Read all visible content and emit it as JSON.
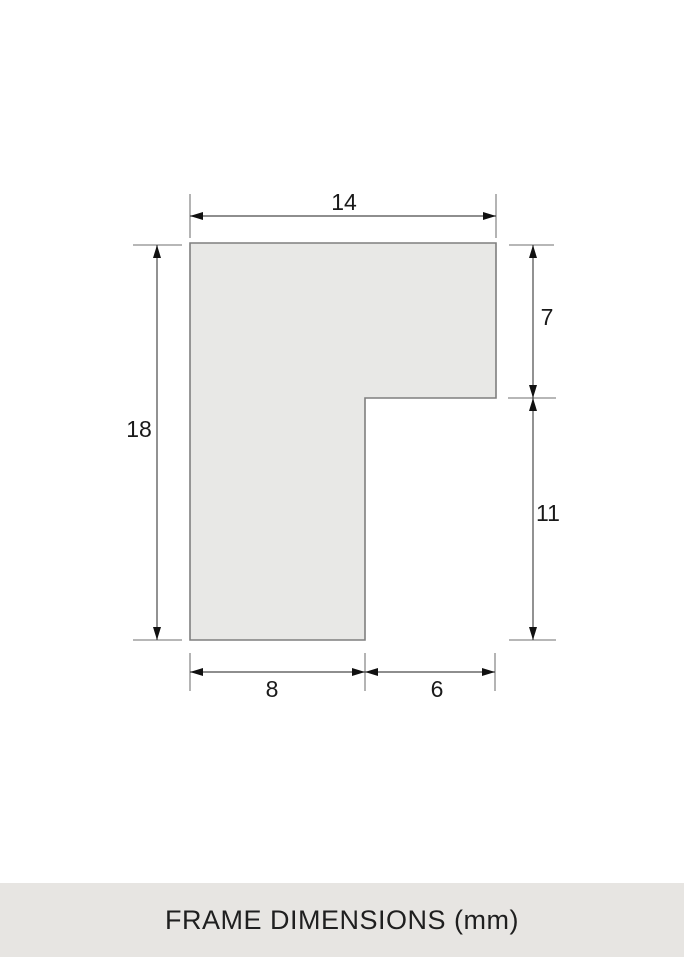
{
  "diagram": {
    "type": "technical-dimension-drawing",
    "unit": "mm",
    "dimensions": {
      "total_width": "14",
      "top_section_height": "7",
      "total_height": "18",
      "lower_right_height": "11",
      "bottom_left_width": "8",
      "bottom_right_width": "6"
    },
    "colors": {
      "shape_fill": "#E8E8E6",
      "shape_stroke": "#7F7F7F",
      "dimension_line": "#4A4A4A",
      "extension_line": "#8C8C8C",
      "arrow": "#111111",
      "label_text": "#1A1A1A"
    }
  },
  "caption": {
    "label": "FRAME DIMENSIONS (mm)",
    "background": "#E7E5E2",
    "text_color": "#1F1F1F"
  }
}
